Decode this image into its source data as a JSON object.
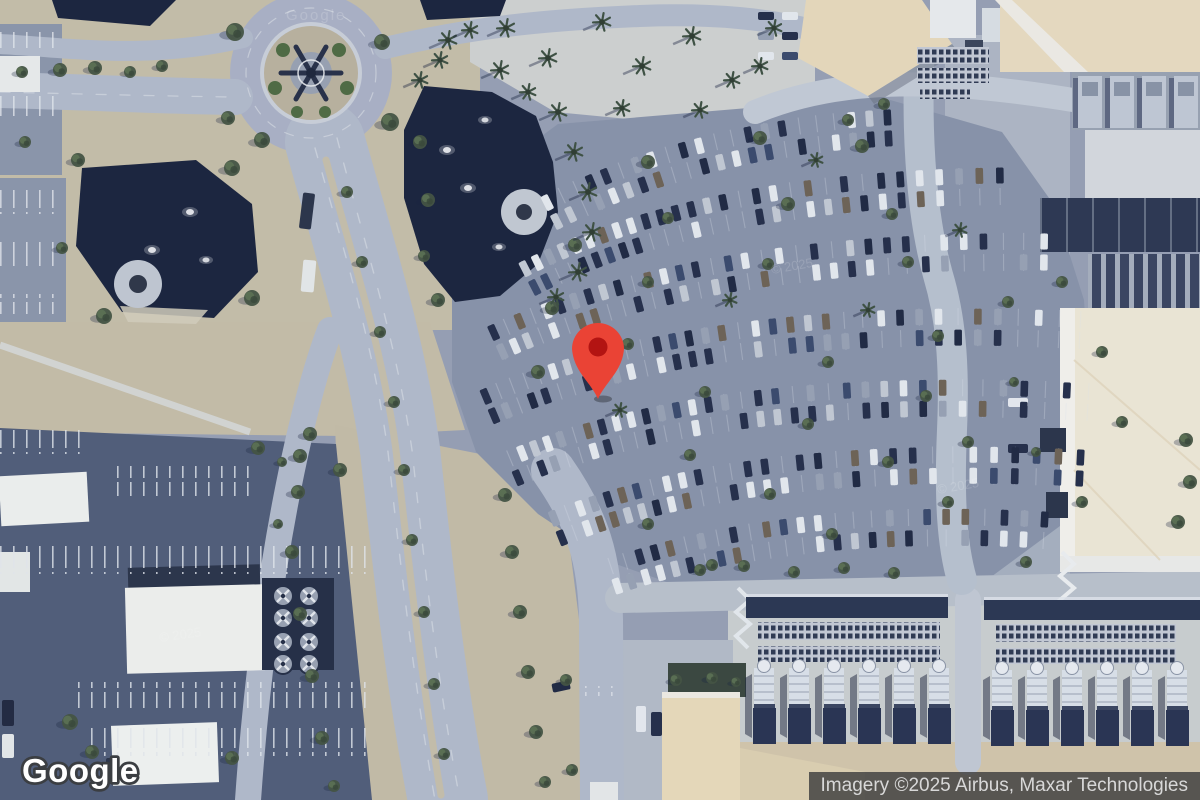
{
  "branding": {
    "logo_text": "Google"
  },
  "attribution": {
    "text": "Imagery ©2025 Airbus, Maxar Technologies",
    "background": "#424242",
    "text_color": "#D8D8D8"
  },
  "map": {
    "view": "satellite",
    "marker": {
      "color": "#EA4335",
      "inner_color": "#B31412"
    },
    "watermark_year": "© 2025",
    "watermark_logo": "Google"
  }
}
